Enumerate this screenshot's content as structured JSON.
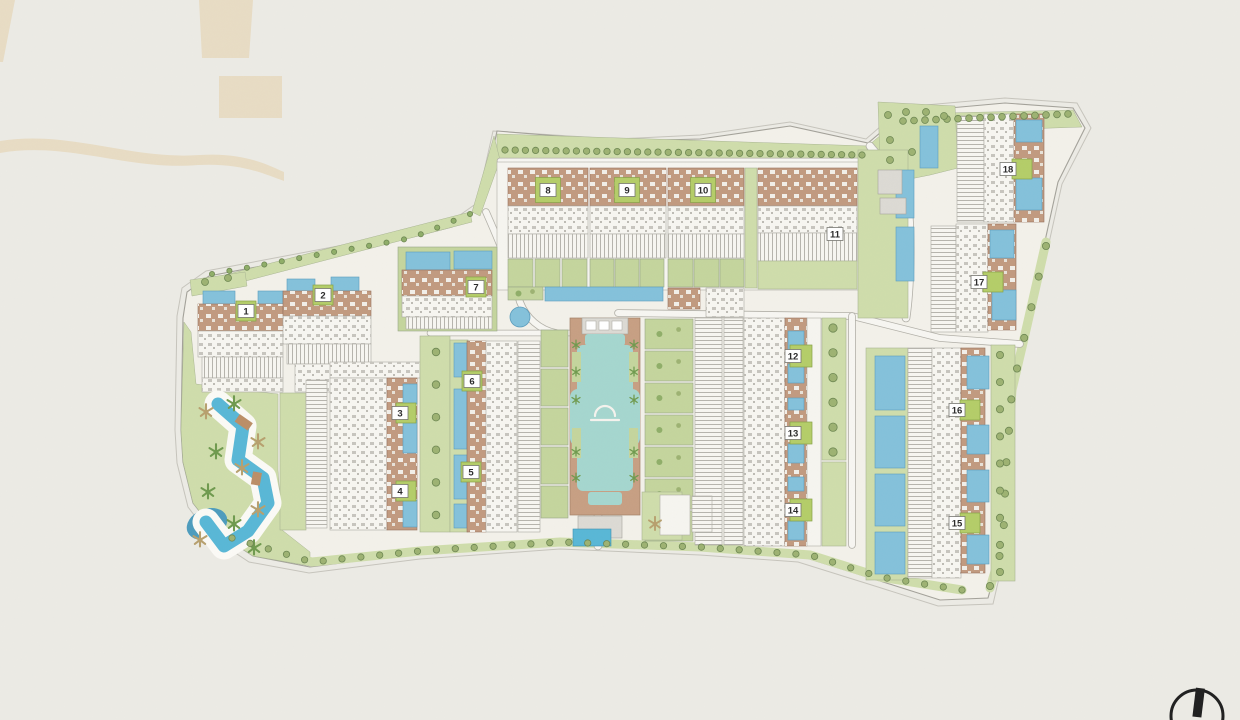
{
  "plan": {
    "badges": [
      {
        "label": "1",
        "x": 246,
        "y": 311,
        "gs": 20,
        "gx": 0
      },
      {
        "label": "2",
        "x": 323,
        "y": 295,
        "gs": 20,
        "gx": 0
      },
      {
        "label": "3",
        "x": 400,
        "y": 413,
        "gs": 20,
        "gx": 6
      },
      {
        "label": "4",
        "x": 400,
        "y": 491,
        "gs": 20,
        "gx": 6
      },
      {
        "label": "5",
        "x": 471,
        "y": 472,
        "gs": 20,
        "gx": 0
      },
      {
        "label": "6",
        "x": 472,
        "y": 381,
        "gs": 20,
        "gx": 0
      },
      {
        "label": "7",
        "x": 476,
        "y": 287,
        "gs": 20,
        "gx": 0
      },
      {
        "label": "8",
        "x": 548,
        "y": 190,
        "gs": 25,
        "gx": 0
      },
      {
        "label": "9",
        "x": 627,
        "y": 190,
        "gs": 25,
        "gx": 0
      },
      {
        "label": "10",
        "x": 703,
        "y": 190,
        "gs": 25,
        "gx": 0
      },
      {
        "label": "11",
        "x": 835,
        "y": 234,
        "gs": 0,
        "gx": 0
      },
      {
        "label": "12",
        "x": 793,
        "y": 356,
        "gs": 22,
        "gx": 8
      },
      {
        "label": "13",
        "x": 793,
        "y": 433,
        "gs": 22,
        "gx": 8
      },
      {
        "label": "14",
        "x": 793,
        "y": 510,
        "gs": 22,
        "gx": 8
      },
      {
        "label": "15",
        "x": 957,
        "y": 523,
        "gs": 20,
        "gx": 13
      },
      {
        "label": "16",
        "x": 957,
        "y": 410,
        "gs": 20,
        "gx": 13
      },
      {
        "label": "17",
        "x": 979,
        "y": 282,
        "gs": 20,
        "gx": 14
      },
      {
        "label": "18",
        "x": 1008,
        "y": 169,
        "gs": 20,
        "gx": 14
      }
    ],
    "compass": {
      "glyph": "north-indicator"
    }
  },
  "colors": {
    "background": "#ecebe5",
    "site": "#f3f1ea",
    "boundary": "#a3a199",
    "lawn": "#cfddab",
    "lawn2": "#c4d59d",
    "tree": "#9db272",
    "treeStroke": "#6d8752",
    "tan": "#c19a7f",
    "roof": "#f7f6f1",
    "stripe": "#b6b4ad",
    "pool": "#84c1db",
    "poolDeep": "#58b7d6",
    "poolTeal": "#a5d6cf",
    "pond": "#4d9cbd",
    "deck": "#c79f83",
    "pad": "#dcdad4",
    "road": "#f7f6f2",
    "roadEdge": "#b2b0a8",
    "badgeGreen": "#b4cd68",
    "badgeGreenStroke": "#87a246",
    "chip": "#ffffff",
    "chipStroke": "#75756f",
    "number": "#2a2a2a",
    "watermark": "#e8dcc4",
    "compass": "#1f1f1f",
    "palm": "#6f9a4e",
    "palmTan": "#b7a06e"
  }
}
